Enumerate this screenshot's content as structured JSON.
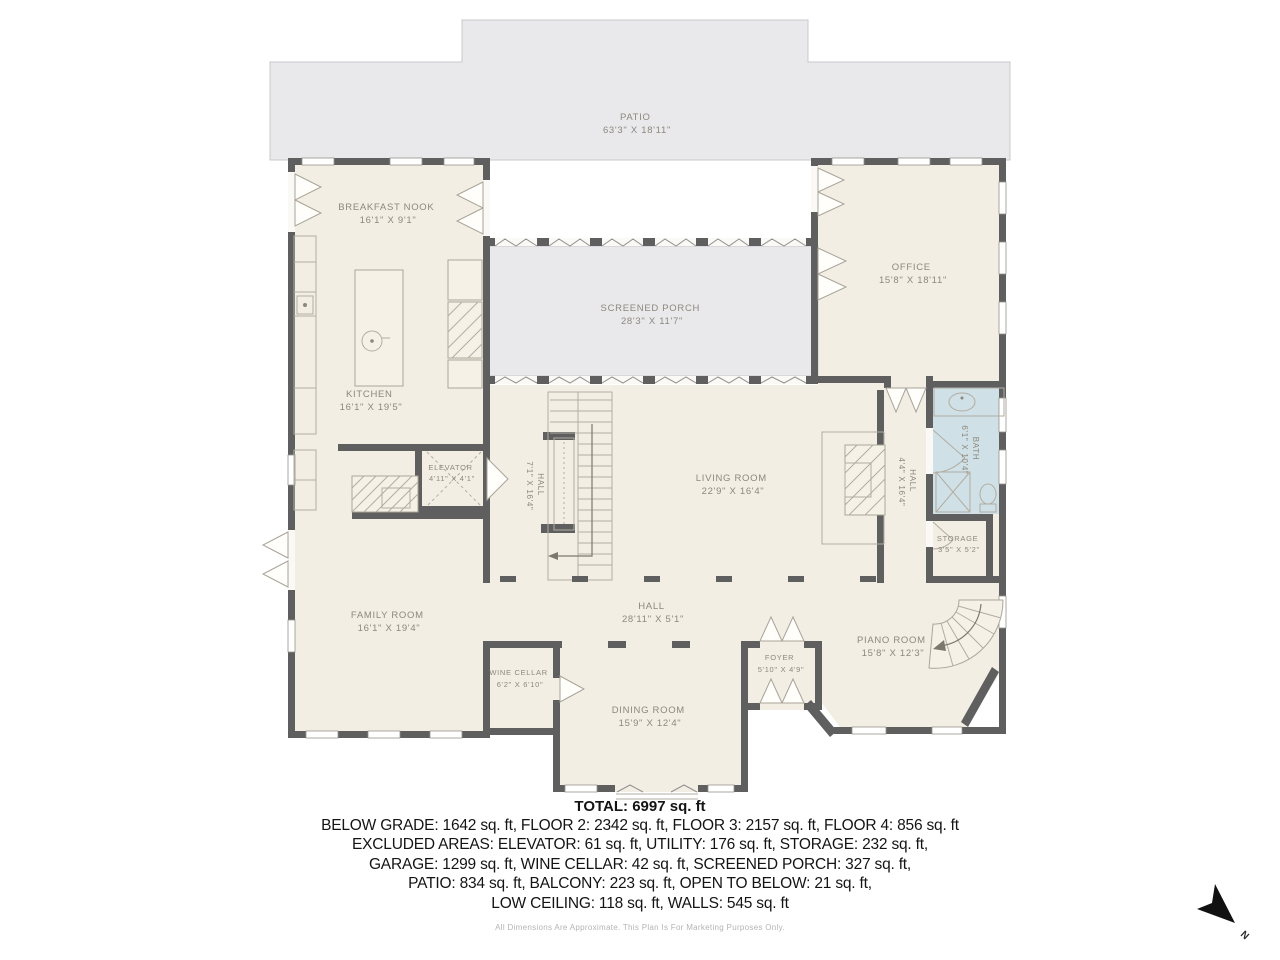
{
  "rooms": [
    {
      "id": "patio",
      "name": "PATIO",
      "dims": "63'3\" X 18'11\""
    },
    {
      "id": "breakfast-nook",
      "name": "BREAKFAST NOOK",
      "dims": "16'1\" X 9'1\""
    },
    {
      "id": "office",
      "name": "OFFICE",
      "dims": "15'8\" X 18'11\""
    },
    {
      "id": "screened-porch",
      "name": "SCREENED PORCH",
      "dims": "28'3\" X 11'7\""
    },
    {
      "id": "kitchen",
      "name": "KITCHEN",
      "dims": "16'1\" X 19'5\""
    },
    {
      "id": "elevator",
      "name": "ELEVATOR",
      "dims": "4'11\" X 4'1\""
    },
    {
      "id": "hall-stair",
      "name": "HALL",
      "dims": "7'1\" X 16'4\""
    },
    {
      "id": "living-room",
      "name": "LIVING ROOM",
      "dims": "22'9\" X 16'4\""
    },
    {
      "id": "hall-right",
      "name": "HALL",
      "dims": "4'4\" X 16'4\""
    },
    {
      "id": "bath",
      "name": "BATH",
      "dims": "6'1\" X 10'4\""
    },
    {
      "id": "storage",
      "name": "STORAGE",
      "dims": "3'5\" X 5'2\""
    },
    {
      "id": "family-room",
      "name": "FAMILY ROOM",
      "dims": "16'1\" X 19'4\""
    },
    {
      "id": "hall-main",
      "name": "HALL",
      "dims": "28'11\" X 5'1\""
    },
    {
      "id": "wine-cellar",
      "name": "WINE CELLAR",
      "dims": "6'2\" X 6'10\""
    },
    {
      "id": "foyer",
      "name": "FOYER",
      "dims": "5'10\" X 4'9\""
    },
    {
      "id": "dining-room",
      "name": "DINING ROOM",
      "dims": "15'9\" X 12'4\""
    },
    {
      "id": "piano-room",
      "name": "PIANO ROOM",
      "dims": "15'8\" X 12'3\""
    }
  ],
  "summary": {
    "total": "TOTAL: 6997 sq. ft",
    "lines": [
      "BELOW GRADE: 1642 sq. ft, FLOOR 2: 2342 sq. ft, FLOOR 3: 2157 sq. ft, FLOOR 4: 856 sq. ft",
      "EXCLUDED AREAS: ELEVATOR: 61 sq. ft, UTILITY: 176 sq. ft, STORAGE: 232 sq. ft,",
      "GARAGE: 1299 sq. ft, WINE CELLAR: 42 sq. ft, SCREENED PORCH: 327 sq. ft,",
      "PATIO: 834 sq. ft, BALCONY: 223 sq. ft, OPEN TO BELOW: 21 sq. ft,",
      "LOW CEILING: 118 sq. ft, WALLS: 545 sq. ft"
    ],
    "disclaimer": "All Dimensions Are Approximate. This Plan Is For Marketing Purposes Only."
  },
  "compass": {
    "label": "N"
  },
  "colors": {
    "room_fill": "#f3eee4",
    "outdoor_fill": "#e9e9ec",
    "bath_fill": "#cfe0e6",
    "wall": "#5f5f5f",
    "room_label": "#8d887d",
    "summary_text": "#141414"
  }
}
